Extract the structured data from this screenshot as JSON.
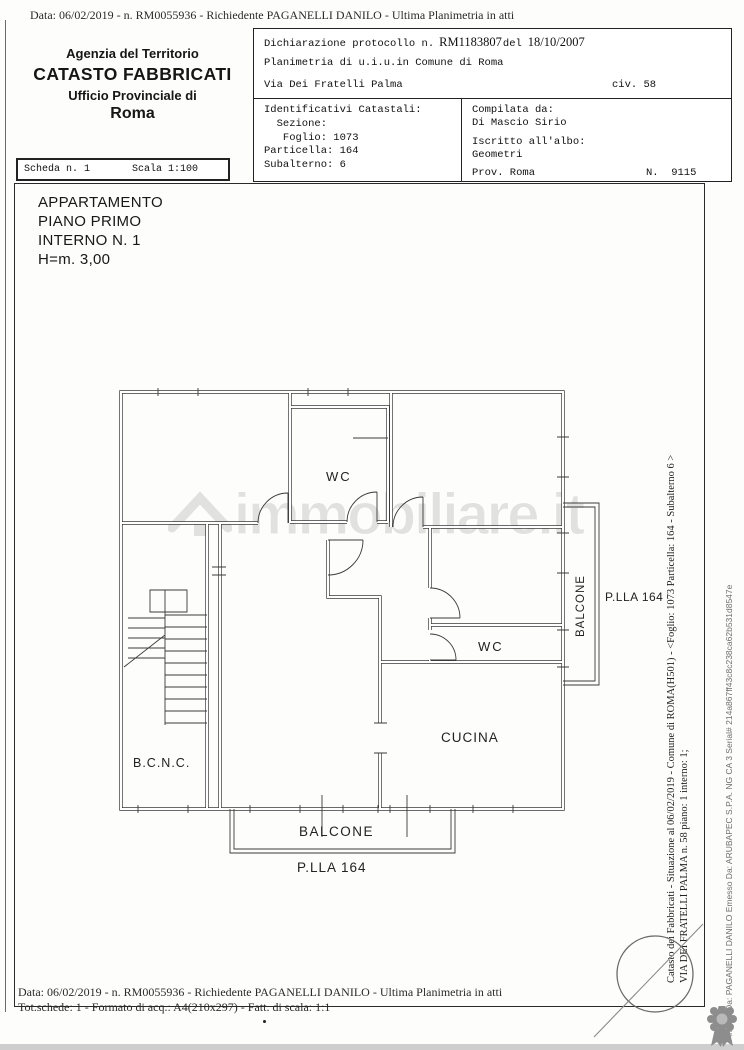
{
  "page": {
    "top_line": "Data: 06/02/2019 -  n. RM0055936 - Richiedente PAGANELLI DANILO - Ultima Planimetria in atti",
    "bottom_line1": "Data: 06/02/2019 -  n. RM0055936 - Richiedente PAGANELLI DANILO - Ultima Planimetria in atti",
    "bottom_line2": "Tot.schede:  1 - Formato di acq.:  A4(210x297) - Fatt. di scala:  1:1"
  },
  "header": {
    "agency": {
      "line1": "Agenzia del Territorio",
      "line2": "CATASTO FABBRICATI",
      "line3": "Ufficio Provinciale di",
      "line4": "Roma"
    },
    "scheda": {
      "label": "Scheda n. 1",
      "scala": "Scala 1:100"
    },
    "declaration": {
      "protocol_label": "Dichiarazione protocollo n.",
      "protocol_number": "RM1183807",
      "del_word": "del",
      "protocol_date": "18/10/2007",
      "line2": "Planimetria di u.i.u.in Comune di Roma",
      "street": "Via Dei Fratelli Palma",
      "civ": "civ. 58"
    },
    "identifiers": {
      "lines": [
        "Identificativi Catastali:",
        "  Sezione:",
        "   Foglio: 1073",
        "Particella: 164",
        "Subalterno: 6"
      ]
    },
    "compiler": {
      "label": "Compilata da:",
      "name": "Di Mascio Sirio",
      "albo_label": "Iscritto all'albo:",
      "albo": "Geometri",
      "prov": "Prov. Roma",
      "number": "N.  9115"
    }
  },
  "unit": {
    "lines": [
      "APPARTAMENTO",
      "PIANO PRIMO",
      "INTERNO N. 1",
      "H=m. 3,00"
    ]
  },
  "plan": {
    "labels": {
      "wc_top": "WC",
      "wc_bottom": "WC",
      "cucina": "CUCINA",
      "bcnc": "B.C.N.C.",
      "balcone_bottom": "BALCONE",
      "balcone_right": "BALCONE",
      "plla_bottom": "P.LLA 164",
      "plla_right": "P.LLA 164"
    }
  },
  "watermark": "immobiliare.it",
  "side_text": {
    "line1": "Catasto dei Fabbricati - Situazione al 06/02/2019 - Comune di ROMA(H501) - <Foglio: 1073 Particella: 164 - Subalterno 6 >",
    "line2": "VIA DEI FRATELLI PALMA n. 58 piano: 1 interno: 1;",
    "signature": "Firmato Da: PAGANELLI DANILO Emesso Da: ARUBAPEC S.P.A. NG CA 3 Serial# 214a867ff43c8c238ca62b531d8547e"
  },
  "colors": {
    "ink": "#1b1b1b",
    "wall": "#3a3a3a",
    "watermark": "#c6c6c6",
    "stamp": "#6b6b6b",
    "rosette": "#8d8d8d"
  }
}
